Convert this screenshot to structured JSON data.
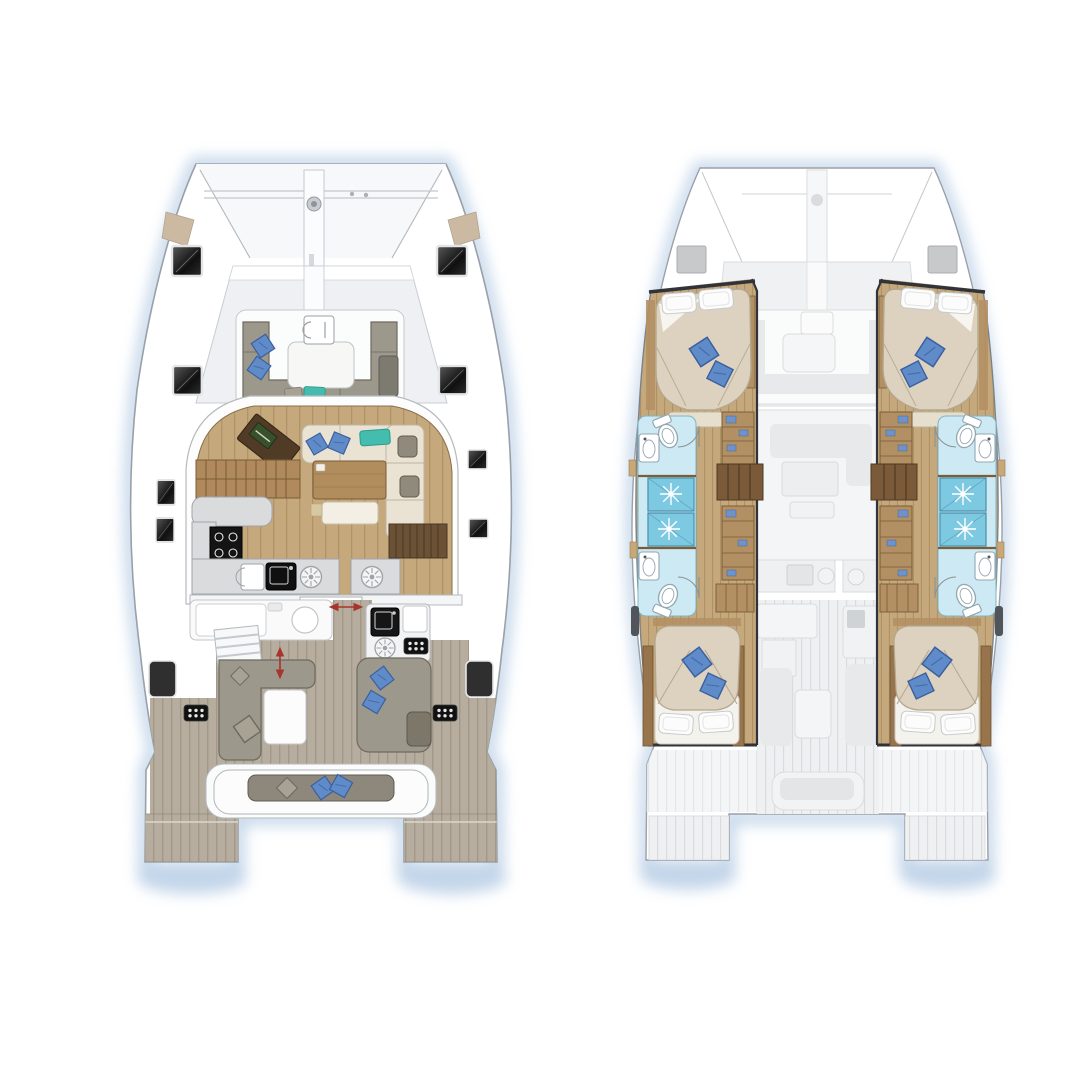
{
  "title": "Catamaran layout plans",
  "palette": {
    "page_bg": "#ffffff",
    "water": "#b9cfe6",
    "hull_fill": "#ffffff",
    "hull_line": "#9aa0a8",
    "deck_line": "#b6babd",
    "tramp": "#f7f8fa",
    "glass": "#eef0f3",
    "anchor_tan": "#cbb9a2",
    "hatch_frame": "#e3e4e6",
    "wood_floor": "#c5a87c",
    "wood_line": "#9e8257",
    "wood_dark": "#7a5c36",
    "slat_wood": "#b08a5c",
    "table_wood": "#b18c5c",
    "nav_brown": "#503b27",
    "laptop_green": "#39512b",
    "cream": "#eae3d3",
    "cream_line": "#bdb5a0",
    "stool_gray": "#8f8a7c",
    "sofa_gray": "#9d988c",
    "sofa_line": "#6f6a5e",
    "pillow_gray": "#a8a294",
    "pillow_blue": "#5f8cc9",
    "pillow_blue_dark": "#3c5f9e",
    "pillow_teal": "#44bdaf",
    "counter": "#d9dbdd",
    "counter_line": "#9fa4a9",
    "appliance": "#141414",
    "teak": "#b6ad9f",
    "teak_line": "#948b7c",
    "window_dark": "#2f2f2f",
    "red_arrow": "#a8352c",
    "bath_floor": "#cdeaf4",
    "bath_line": "#7fb4c6",
    "shower_blue": "#7ec9e2",
    "shower_line": "#4f93ad",
    "porcelain": "#ffffff",
    "porcelain_line": "#93a7b0",
    "wardrobe_wood": "#b29064",
    "duvet": "#dcd2bf",
    "duvet_line": "#b3a78e",
    "bed_wood": "#97744c",
    "bulkhead": "#30343a",
    "ghost_fill": "#eff0f2",
    "ghost_line": "#d9dcde",
    "ghost_shape": "#e7e9ea",
    "gray_hatch": "#c7c9cb"
  },
  "views": [
    {
      "id": "main-deck-plan",
      "areas": [
        "trampoline",
        "forward-cockpit",
        "saloon",
        "galley",
        "aft-cockpit",
        "transom-platforms"
      ],
      "items": [
        "windlass",
        "bowsprit",
        "deck-hatch x8",
        "forward-lounge",
        "forward-table",
        "nav-station",
        "saloon-sofa",
        "dining-table",
        "galley-cooktop",
        "galley-sink",
        "burner x2",
        "fridge",
        "wet-bar",
        "stairs",
        "cockpit-sofa",
        "cockpit-table",
        "outdoor-galley",
        "chaise-lounge",
        "aft-bench",
        "hull-window x2",
        "vent-panel x2",
        "sliding-door-arrow",
        "door-arrow"
      ]
    },
    {
      "id": "lower-deck-plan",
      "areas": [
        "port-hull",
        "starboard-hull",
        "ghosted-main-deck"
      ],
      "items": [
        "forward-cabin-bed x2",
        "aft-cabin-bed x2",
        "bathroom x4",
        "shower x4",
        "toilet x4",
        "washbasin x4",
        "wardrobe x4",
        "companionway-steps x2",
        "bow-hatch x2"
      ]
    }
  ]
}
